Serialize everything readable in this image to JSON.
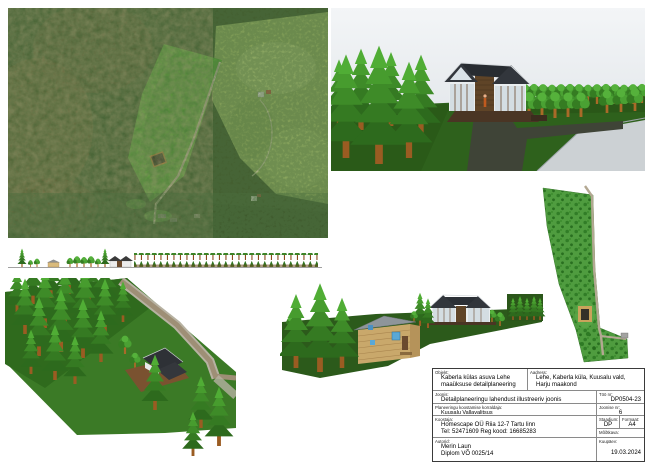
{
  "title_block": {
    "objekt_label": "Objekt:",
    "objekt_line1": "Kaberla külas asuva Lehe",
    "objekt_line2": "maaüksuse detailplaneering",
    "aadress_label": "Aadress:",
    "aadress_line1": "Lehe, Kaberla küla, Kuusalu vald,",
    "aadress_line2": "Harju maakond",
    "joonis_label": "Joonis:",
    "joonis": "Detailplaneeringu lahendust illustreeriv joonis",
    "korraldaja_label": "Planeeringu koostamise korraldaja:",
    "korraldaja": "Kuusalu Vallavalitsus",
    "koostaja_label": "Koostaja:",
    "koostaja_line1": "Homescape OÜ    Riia 12-7  Tartu linn",
    "koostaja_line2": "Tel: 52471609    Reg kood: 16685283",
    "autorid_label": "Autorid:",
    "autor_line1": "Merin Laun",
    "autor_line2": "Diplom VÕ 0025/14",
    "too_nr_label": "Töö nr:",
    "too_nr": "DP0504-23",
    "joonise_nr_label": "Joonise nr:",
    "joonise_nr": "6",
    "staadium_label": "Staadium:",
    "staadium": "DP",
    "formaat_label": "Formaat:",
    "formaat": "A4",
    "mootkava_label": "Mõõtkava:",
    "mootkava": "",
    "kuupaev_label": "Kuupäev:",
    "kuupaev": "19.03.2024"
  },
  "colors": {
    "plan_green": "#4f9c3f",
    "lawn_green": "#2e611c",
    "roof_dark": "#32363c",
    "wood_brown": "#5f4427",
    "road_gray": "#ccd1d4",
    "road_tan": "#b3a892"
  }
}
